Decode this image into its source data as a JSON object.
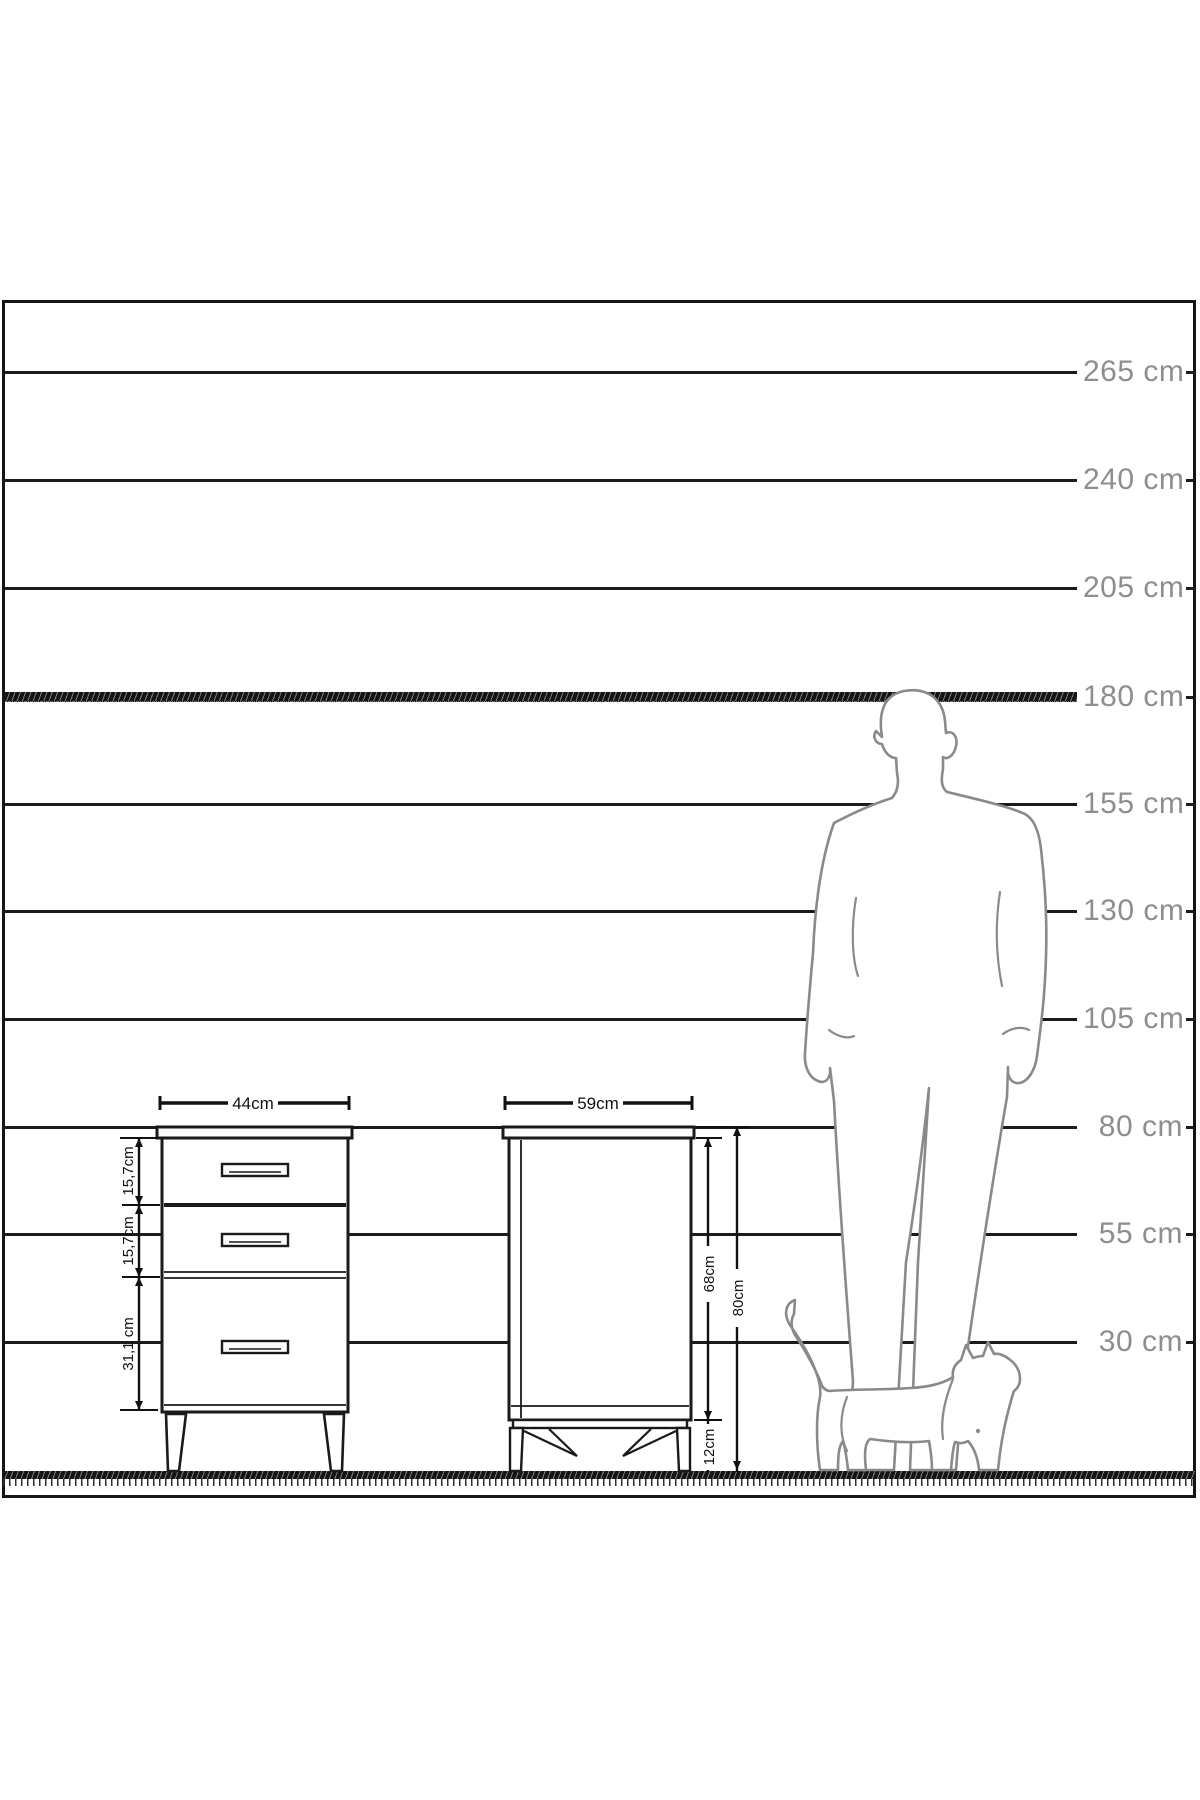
{
  "scale_items": [
    {
      "label": "265 cm"
    },
    {
      "label": "240 cm"
    },
    {
      "label": "205 cm"
    },
    {
      "label": "180 cm"
    },
    {
      "label": "155 cm"
    },
    {
      "label": "130 cm"
    },
    {
      "label": "105 cm"
    },
    {
      "label": "80 cm"
    },
    {
      "label": "55 cm"
    },
    {
      "label": "30 cm"
    }
  ],
  "front_cabinet": {
    "width_label": "44cm",
    "drawer_labels": [
      "15,7cm",
      "15,7cm",
      "31,1 cm"
    ]
  },
  "side_cabinet": {
    "depth_label": "59cm",
    "body_height_label": "68cm",
    "total_height_label": "80cm",
    "leg_height_label": "12cm"
  },
  "figures": {
    "man_icon": "man-silhouette",
    "cat_icon": "cat-silhouette"
  },
  "colors": {
    "line": "#1a1a1a",
    "scale_label": "#8e8e8e",
    "silhouette": "#8a8a8a",
    "dimension_text": "#111111",
    "background": "#ffffff"
  }
}
